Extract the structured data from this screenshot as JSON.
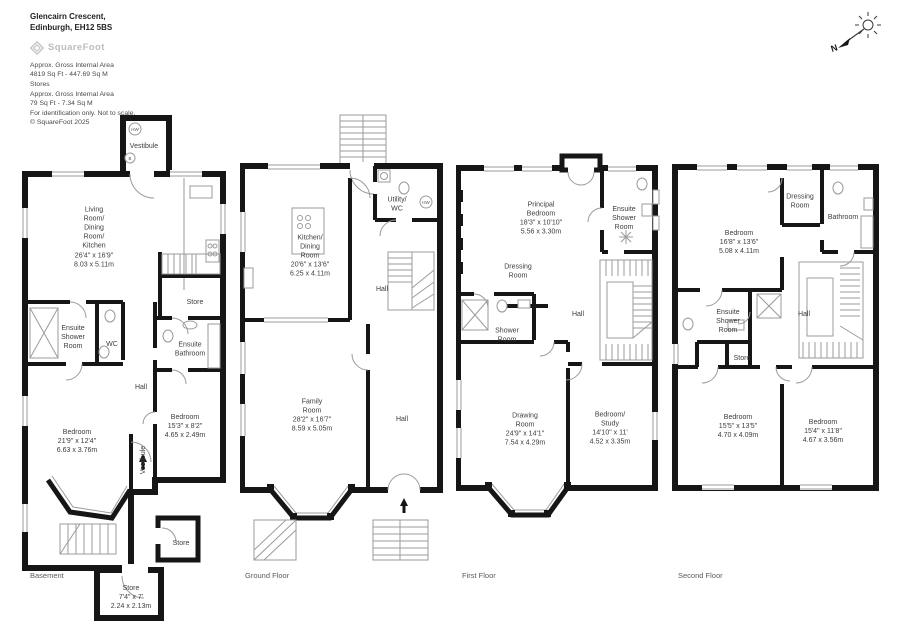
{
  "header": {
    "address_line1": "Glencairn Crescent,",
    "address_line2": "Edinburgh, EH12 5BS",
    "logo_text": "SquareFoot",
    "area_lines": [
      "Approx. Gross Internal Area",
      "4819 Sq Ft - 447.69 Sq M",
      "Stores",
      "Approx. Gross Internal Area",
      "79 Sq Ft - 7.34 Sq M",
      "For identification only. Not to scale.",
      "© SquareFoot 2025"
    ]
  },
  "compass": {
    "north_label": "N"
  },
  "floors": [
    {
      "label": "Basement",
      "badges": {
        "hw": "HW",
        "b": "B"
      },
      "rooms": [
        {
          "name": "Vestibule"
        },
        {
          "name": "Living\nRoom/\nDining\nRoom/\nKitchen",
          "dims_ft": "26'4\" x 16'9\"",
          "dims_m": "8.03 x 5.11m"
        },
        {
          "name": "Ensuite\nShower\nRoom"
        },
        {
          "name": "WC"
        },
        {
          "name": "Store"
        },
        {
          "name": "Ensuite\nBathroom"
        },
        {
          "name": "Hall"
        },
        {
          "name": "Bedroom",
          "dims_ft": "21'9\" x 12'4\"",
          "dims_m": "6.63 x 3.76m"
        },
        {
          "name": "Bedroom",
          "dims_ft": "15'3\" x 8'2\"",
          "dims_m": "4.65 x 2.49m"
        },
        {
          "name": "Vestibule"
        },
        {
          "name": "Store"
        },
        {
          "name": "Store",
          "dims_ft": "7'4\" x 7'",
          "dims_m": "2.24 x 2.13m"
        }
      ]
    },
    {
      "label": "Ground Floor",
      "badges": {
        "hw": "HW"
      },
      "rooms": [
        {
          "name": "Kitchen/\nDining\nRoom",
          "dims_ft": "20'6\" x 13'6\"",
          "dims_m": "6.25 x 4.11m"
        },
        {
          "name": "Utility/\nWC"
        },
        {
          "name": "Hall"
        },
        {
          "name": "Family\nRoom",
          "dims_ft": "28'2\" x 16'7\"",
          "dims_m": "8.59 x 5.05m"
        },
        {
          "name": "Hall"
        }
      ]
    },
    {
      "label": "First Floor",
      "rooms": [
        {
          "name": "Principal\nBedroom",
          "dims_ft": "18'3\" x 10'10\"",
          "dims_m": "5.56 x 3.30m"
        },
        {
          "name": "Ensuite\nShower\nRoom"
        },
        {
          "name": "Dressing\nRoom"
        },
        {
          "name": "Shower\nRoom"
        },
        {
          "name": "Hall"
        },
        {
          "name": "Drawing\nRoom",
          "dims_ft": "24'9\" x 14'1\"",
          "dims_m": "7.54 x 4.29m"
        },
        {
          "name": "Bedroom/\nStudy",
          "dims_ft": "14'10\" x 11'",
          "dims_m": "4.52 x 3.35m"
        }
      ]
    },
    {
      "label": "Second Floor",
      "rooms": [
        {
          "name": "Bedroom",
          "dims_ft": "16'8\" x 13'6\"",
          "dims_m": "5.08 x 4.11m"
        },
        {
          "name": "Dressing\nRoom"
        },
        {
          "name": "Bathroom"
        },
        {
          "name": "Ensuite\nShower\nRoom"
        },
        {
          "name": "Hall"
        },
        {
          "name": "Store"
        },
        {
          "name": "Bedroom",
          "dims_ft": "15'5\" x 13'5\"",
          "dims_m": "4.70 x 4.09m"
        },
        {
          "name": "Bedroom",
          "dims_ft": "15'4\" x 11'8\"",
          "dims_m": "4.67 x 3.56m"
        }
      ]
    }
  ]
}
